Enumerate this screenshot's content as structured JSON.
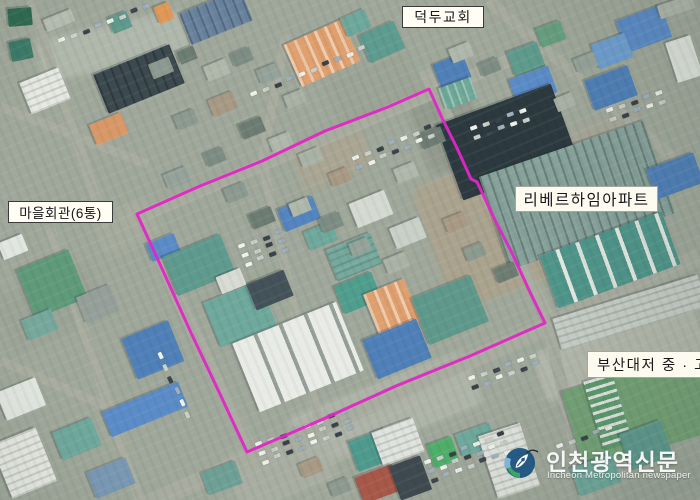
{
  "map_labels": {
    "church": "덕두교회",
    "village_hall": "마을회관(6통)",
    "apartment": "리베르하임아파트",
    "school": "부산대저 중 · 고"
  },
  "watermark": {
    "korean": "인천광역신문",
    "english": "Incheon Metropolitan newspaper",
    "logo_blue": "#17507f",
    "logo_green": "#2fa35c",
    "logo_lightblue": "#7ab2d8"
  },
  "boundary": {
    "color": "#e126c6",
    "stroke_width": 3,
    "points": [
      [
        137,
        214
      ],
      [
        200,
        186
      ],
      [
        262,
        161
      ],
      [
        325,
        131
      ],
      [
        388,
        107
      ],
      [
        429,
        89
      ],
      [
        443,
        120
      ],
      [
        457,
        148
      ],
      [
        471,
        179
      ],
      [
        477,
        182
      ],
      [
        495,
        220
      ],
      [
        512,
        253
      ],
      [
        529,
        290
      ],
      [
        545,
        323
      ],
      [
        470,
        356
      ],
      [
        396,
        386
      ],
      [
        321,
        420
      ],
      [
        247,
        452
      ],
      [
        219,
        392
      ],
      [
        192,
        335
      ],
      [
        164,
        273
      ]
    ]
  },
  "scene": {
    "base_color": "#9fa89a",
    "road_color": "#a8ada0",
    "roads": [
      [
        125,
        222,
        540,
        47,
        13
      ],
      [
        132,
        204,
        260,
        468,
        12
      ],
      [
        138,
        508,
        700,
        257,
        17
      ],
      [
        424,
        70,
        558,
        336,
        12
      ],
      [
        286,
        34,
        262,
        160,
        9
      ],
      [
        262,
        160,
        320,
        428,
        9
      ],
      [
        488,
        0,
        700,
        180,
        11
      ],
      [
        0,
        106,
        148,
        164,
        9
      ],
      [
        30,
        0,
        106,
        228,
        10
      ],
      [
        50,
        228,
        140,
        502,
        10
      ],
      [
        0,
        360,
        148,
        424,
        9
      ],
      [
        548,
        326,
        588,
        500,
        12
      ]
    ],
    "patches": [
      [
        430,
        165,
        120,
        130,
        -20,
        "#b0a28a",
        0.7
      ],
      [
        295,
        135,
        75,
        45,
        -22,
        "#b3a68e",
        0.55
      ],
      [
        290,
        382,
        190,
        58,
        -21,
        "#b4b9ad",
        0.75
      ],
      [
        38,
        24,
        152,
        44,
        -12,
        "#b4baae",
        0.85
      ],
      [
        536,
        328,
        170,
        52,
        -17,
        "#b9bdb0",
        0.8
      ],
      [
        418,
        96,
        64,
        72,
        -20,
        "#8a8f85",
        0.55
      ],
      [
        0,
        276,
        104,
        62,
        -22,
        "#98a294",
        0.5
      ],
      [
        228,
        436,
        104,
        62,
        -21,
        "#abb0a4",
        0.75
      ],
      [
        616,
        468,
        86,
        32,
        -20,
        "#9aa598",
        0.7
      ],
      [
        96,
        206,
        64,
        42,
        -22,
        "#a8ad9f",
        0.7
      ],
      [
        560,
        120,
        90,
        60,
        -20,
        "#a9a598",
        0.6
      ],
      [
        330,
        60,
        90,
        60,
        -23,
        "#9aa294",
        0.5
      ]
    ],
    "buildings": [
      [
        8,
        8,
        24,
        18,
        -5,
        "#2f6b50",
        ""
      ],
      [
        10,
        40,
        22,
        20,
        -12,
        "#3c7a68",
        ""
      ],
      [
        44,
        14,
        30,
        13,
        -22,
        "#b7bdb1",
        ""
      ],
      [
        110,
        14,
        20,
        17,
        -22,
        "#5d9a8c",
        ""
      ],
      [
        98,
        58,
        82,
        42,
        -22,
        "#3c4a50",
        "rd"
      ],
      [
        24,
        74,
        42,
        34,
        -22,
        "#e6e9e2",
        "rg"
      ],
      [
        92,
        118,
        34,
        22,
        -22,
        "#d89868",
        ""
      ],
      [
        156,
        4,
        16,
        18,
        -22,
        "#e09858",
        ""
      ],
      [
        183,
        0,
        66,
        34,
        -22,
        "#6b84a0",
        "rd"
      ],
      [
        290,
        30,
        64,
        46,
        -24,
        "#df9f6e",
        "ro"
      ],
      [
        363,
        27,
        38,
        30,
        -24,
        "#5f9c90",
        ""
      ],
      [
        343,
        13,
        26,
        20,
        -24,
        "#6fa89c",
        ""
      ],
      [
        436,
        58,
        32,
        26,
        -22,
        "#4f80b8",
        ""
      ],
      [
        510,
        46,
        32,
        26,
        -20,
        "#5f9c8e",
        ""
      ],
      [
        538,
        24,
        26,
        20,
        -20,
        "#67a080",
        ""
      ],
      [
        620,
        12,
        48,
        34,
        -20,
        "#5b8cc8",
        ""
      ],
      [
        594,
        38,
        36,
        26,
        -20,
        "#6f9fd0",
        ""
      ],
      [
        588,
        72,
        46,
        32,
        -20,
        "#4f80b8",
        ""
      ],
      [
        512,
        72,
        42,
        28,
        -20,
        "#5b8cc8",
        ""
      ],
      [
        441,
        82,
        34,
        23,
        -20,
        "#6fa896",
        "rb"
      ],
      [
        671,
        38,
        26,
        42,
        -18,
        "#dfe3dc",
        ""
      ],
      [
        658,
        0,
        36,
        14,
        -18,
        "#b0b6aa",
        ""
      ],
      [
        446,
        102,
        122,
        80,
        -20,
        "#2c3a40",
        ""
      ],
      [
        490,
        146,
        174,
        98,
        -19,
        "#87a29b",
        "rd"
      ],
      [
        650,
        160,
        50,
        32,
        -20,
        "#4f80b8",
        ""
      ],
      [
        545,
        232,
        130,
        56,
        -20,
        "#4f958a",
        "tr"
      ],
      [
        554,
        296,
        152,
        34,
        -17,
        "#c6cec6",
        "rg"
      ],
      [
        570,
        370,
        138,
        82,
        -17,
        "#74a276",
        ""
      ],
      [
        593,
        376,
        30,
        72,
        -17,
        "#5d9a6e",
        "gr"
      ],
      [
        24,
        258,
        56,
        52,
        -22,
        "#5f9a7a",
        ""
      ],
      [
        0,
        238,
        26,
        18,
        -22,
        "#e2e6e0",
        ""
      ],
      [
        148,
        238,
        30,
        19,
        -22,
        "#5b8cc8",
        ""
      ],
      [
        128,
        328,
        50,
        44,
        -22,
        "#4f80b8",
        ""
      ],
      [
        104,
        396,
        82,
        27,
        -22,
        "#5b8cc8",
        ""
      ],
      [
        0,
        384,
        42,
        30,
        -22,
        "#e2e6e0",
        ""
      ],
      [
        0,
        434,
        48,
        58,
        -22,
        "#e6e9e2",
        "rg"
      ],
      [
        56,
        424,
        42,
        30,
        -22,
        "#6fa89c",
        ""
      ],
      [
        90,
        464,
        42,
        28,
        -22,
        "#7a99b5",
        ""
      ],
      [
        24,
        314,
        32,
        22,
        -22,
        "#77a89c",
        ""
      ],
      [
        80,
        290,
        36,
        28,
        -22,
        "#96a09a",
        ""
      ],
      [
        204,
        466,
        36,
        24,
        -20,
        "#6fa096",
        ""
      ],
      [
        168,
        244,
        62,
        42,
        -22,
        "#5f9a8e",
        ""
      ],
      [
        210,
        290,
        60,
        48,
        -22,
        "#6fa89c",
        ""
      ],
      [
        280,
        202,
        38,
        24,
        -22,
        "#5585c0",
        ""
      ],
      [
        250,
        276,
        40,
        28,
        -22,
        "#44525a",
        ""
      ],
      [
        330,
        240,
        48,
        34,
        -22,
        "#77aa9e",
        "rg"
      ],
      [
        338,
        278,
        40,
        30,
        -22,
        "#4f9e8e",
        ""
      ],
      [
        218,
        272,
        26,
        18,
        -22,
        "#d8dcd4",
        ""
      ],
      [
        242,
        320,
        112,
        74,
        -22,
        "#e9ece6",
        "pn"
      ],
      [
        370,
        285,
        44,
        46,
        -22,
        "#dfa070",
        "ro"
      ],
      [
        418,
        285,
        64,
        50,
        -22,
        "#5f998c",
        ""
      ],
      [
        368,
        328,
        58,
        42,
        -22,
        "#4f80b8",
        ""
      ],
      [
        352,
        196,
        38,
        26,
        -22,
        "#d5dad1",
        ""
      ],
      [
        392,
        222,
        32,
        22,
        -22,
        "#c8d0c8",
        ""
      ],
      [
        306,
        226,
        30,
        20,
        -22,
        "#6fa89c",
        ""
      ],
      [
        352,
        434,
        40,
        32,
        -20,
        "#4f9a8e",
        ""
      ],
      [
        376,
        424,
        44,
        36,
        -20,
        "#e0e4de",
        "rg"
      ],
      [
        358,
        470,
        40,
        28,
        -20,
        "#a85848",
        ""
      ],
      [
        394,
        460,
        33,
        36,
        -20,
        "#3f4a50",
        ""
      ],
      [
        430,
        440,
        26,
        25,
        -20,
        "#4fae6a",
        ""
      ],
      [
        458,
        428,
        36,
        24,
        -20,
        "#6fa89c",
        ""
      ],
      [
        624,
        426,
        44,
        38,
        -20,
        "#5f9a8e",
        ""
      ],
      [
        574,
        460,
        44,
        30,
        -20,
        "#6fa89c",
        ""
      ],
      [
        487,
        428,
        44,
        66,
        -18,
        "#dfe3dc",
        "rg"
      ]
    ],
    "small_houses": [
      [
        150,
        60,
        22,
        16
      ],
      [
        178,
        48,
        18,
        14
      ],
      [
        205,
        62,
        24,
        16
      ],
      [
        232,
        50,
        20,
        14
      ],
      [
        258,
        66,
        22,
        15
      ],
      [
        285,
        92,
        20,
        14
      ],
      [
        210,
        95,
        26,
        18
      ],
      [
        175,
        112,
        22,
        15
      ],
      [
        240,
        120,
        24,
        16
      ],
      [
        270,
        135,
        22,
        15
      ],
      [
        205,
        150,
        20,
        14
      ],
      [
        165,
        170,
        24,
        16
      ],
      [
        300,
        150,
        22,
        15
      ],
      [
        330,
        170,
        20,
        14
      ],
      [
        225,
        185,
        22,
        15
      ],
      [
        250,
        210,
        24,
        16
      ],
      [
        290,
        200,
        20,
        14
      ],
      [
        320,
        215,
        22,
        15
      ],
      [
        350,
        240,
        20,
        14
      ],
      [
        385,
        255,
        24,
        16
      ],
      [
        445,
        215,
        22,
        15
      ],
      [
        465,
        245,
        20,
        14
      ],
      [
        495,
        265,
        22,
        15
      ],
      [
        450,
        45,
        22,
        15
      ],
      [
        480,
        60,
        20,
        14
      ],
      [
        575,
        55,
        22,
        15
      ],
      [
        555,
        95,
        20,
        14
      ],
      [
        300,
        460,
        22,
        15
      ],
      [
        330,
        480,
        20,
        14
      ],
      [
        420,
        130,
        24,
        16
      ],
      [
        395,
        165,
        22,
        15
      ]
    ],
    "house_colors": [
      "#8c9a90",
      "#6e7d74",
      "#b0b8ac",
      "#7d8d84",
      "#95a39a",
      "#aab2a6",
      "#a89a85"
    ],
    "car_clusters": [
      [
        58,
        40,
        -22,
        1,
        8
      ],
      [
        250,
        94,
        -23,
        1,
        10
      ],
      [
        352,
        158,
        -23,
        2,
        7
      ],
      [
        606,
        110,
        -20,
        2,
        5
      ],
      [
        255,
        444,
        -21,
        3,
        8
      ],
      [
        424,
        462,
        -21,
        3,
        7
      ],
      [
        556,
        446,
        -21,
        1,
        5
      ],
      [
        160,
        352,
        64,
        1,
        6
      ],
      [
        238,
        246,
        -21,
        3,
        4
      ],
      [
        470,
        128,
        -20,
        2,
        5
      ],
      [
        468,
        378,
        -21,
        2,
        6
      ]
    ],
    "car_colors": [
      "#eef0ea",
      "#c9cfc9",
      "#39424a",
      "#9fb0bd"
    ]
  }
}
